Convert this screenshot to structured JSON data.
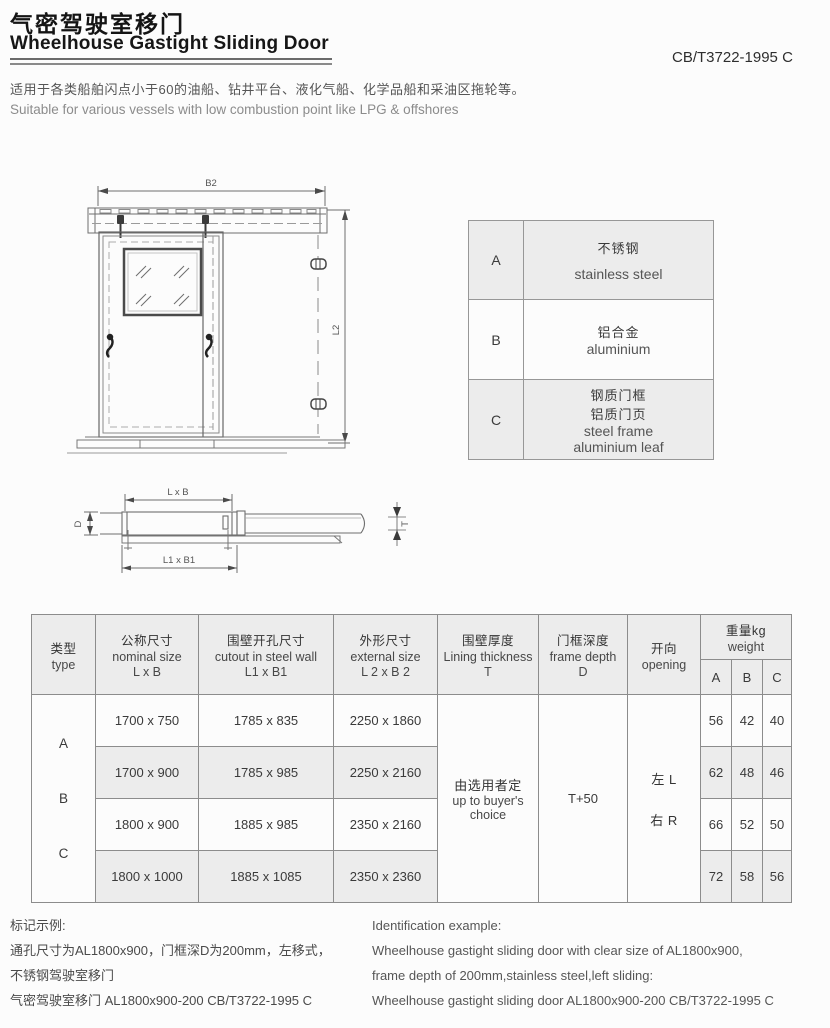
{
  "page": {
    "title_cn": "气密驾驶室移门",
    "title_en": "Wheelhouse Gastight Sliding Door",
    "standard_code": "CB/T3722-1995 C",
    "description_cn": "适用于各类船舶闪点小于60的油船、钻井平台、液化气船、化学品船和采油区拖轮等。",
    "description_en": "Suitable for various vessels with low combustion point like LPG & offshores"
  },
  "front_view": {
    "width_label": "B2",
    "height_label": "L2"
  },
  "top_view": {
    "top_label": "L x B",
    "bottom_label": "L1 x B1",
    "left_label": "D",
    "right_label": "T"
  },
  "material_table": {
    "rows": [
      {
        "key": "A",
        "cn": "不锈钢",
        "en": "stainless steel"
      },
      {
        "key": "B",
        "cn": "铝合金",
        "en": "aluminium"
      },
      {
        "key": "C",
        "cn1": "钢质门框",
        "cn2": "铝质门页",
        "en1": "steel frame",
        "en2": "aluminium leaf"
      }
    ]
  },
  "spec_table": {
    "headers": {
      "type_cn": "类型",
      "type_en": "type",
      "nominal_cn": "公称尺寸",
      "nominal_en": "nominal size",
      "nominal_sub": "L x B",
      "cutout_cn": "围壁开孔尺寸",
      "cutout_en": "cutout in steel wall",
      "cutout_sub": "L1 x B1",
      "external_cn": "外形尺寸",
      "external_en": "external size",
      "external_sub": "L 2  x B 2",
      "lining_cn": "围壁厚度",
      "lining_en": "Lining thickness",
      "lining_sub": "T",
      "frame_cn": "门框深度",
      "frame_en": "frame depth",
      "frame_sub": "D",
      "opening_cn": "开向",
      "opening_en": "opening",
      "weight_cn": "重量kg",
      "weight_en": "weight",
      "weight_cols": [
        "A",
        "B",
        "C"
      ]
    },
    "type_letters": [
      "A",
      "B",
      "C"
    ],
    "rows": [
      {
        "nominal": "1700 x 750",
        "cutout": "1785 x 835",
        "external": "2250 x 1860",
        "wa": "56",
        "wb": "42",
        "wc": "40"
      },
      {
        "nominal": "1700 x 900",
        "cutout": "1785 x 985",
        "external": "2250 x 2160",
        "wa": "62",
        "wb": "48",
        "wc": "46"
      },
      {
        "nominal": "1800 x 900",
        "cutout": "1885 x 985",
        "external": "2350 x 2160",
        "wa": "66",
        "wb": "52",
        "wc": "50"
      },
      {
        "nominal": "1800 x 1000",
        "cutout": "1885 x 1085",
        "external": "2350 x 2360",
        "wa": "72",
        "wb": "58",
        "wc": "56"
      }
    ],
    "merged": {
      "lining_cn": "由选用者定",
      "lining_en1": "up to buyer's",
      "lining_en2": "choice",
      "frame_depth": "T+50",
      "opening_left": "左 L",
      "opening_right": "右 R"
    }
  },
  "footer": {
    "left": [
      "标记示例:",
      "通孔尺寸为AL1800x900，门框深D为200mm，左移式，",
      "不锈钢驾驶室移门",
      "气密驾驶室移门 AL1800x900-200 CB/T3722-1995 C"
    ],
    "right": [
      "Identification example:",
      "Wheelhouse gastight sliding door with clear size of AL1800x900,",
      "frame depth of 200mm,stainless steel,left sliding:",
      "Wheelhouse gastight sliding door AL1800x900-200 CB/T3722-1995 C"
    ]
  },
  "colors": {
    "page_bg": "#fcfcfc",
    "table_header_bg": "#ececec",
    "table_alt_row_bg": "#ececec",
    "table_border": "#8c8c8c",
    "drawing_line": "#6e6e6e",
    "title_text": "#141414",
    "body_text": "#3a3a3a"
  }
}
